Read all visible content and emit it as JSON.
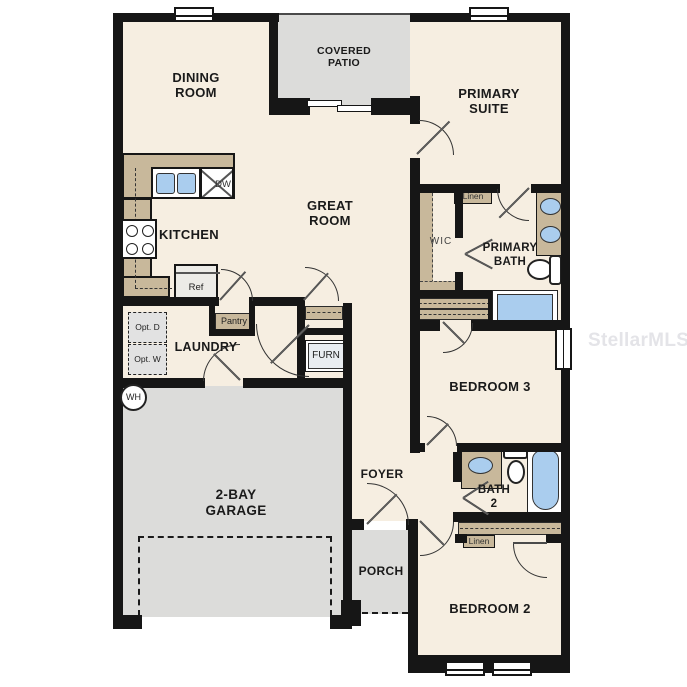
{
  "title": "Single-story floor plan",
  "watermark": "StellarMLS",
  "rooms": {
    "dining_room": "DINING\nROOM",
    "covered_patio": "COVERED\nPATIO",
    "primary_suite": "PRIMARY\nSUITE",
    "kitchen": "KITCHEN",
    "great_room": "GREAT\nROOM",
    "wic": "WIC",
    "primary_bath": "PRIMARY\nBATH",
    "laundry": "LAUNDRY",
    "bedroom_3": "BEDROOM 3",
    "garage": "2-BAY\nGARAGE",
    "foyer": "FOYER",
    "bath_2": "BATH\n2",
    "porch": "PORCH",
    "bedroom_2": "BEDROOM 2"
  },
  "fixtures": {
    "dishwasher": "DW",
    "refrigerator": "Ref",
    "pantry": "Pantry",
    "furnace": "FURN",
    "water_heater": "WH",
    "linen_primary": "Linen",
    "linen_hall": "Linen",
    "optional_dryer": "Opt.\nD",
    "optional_washer": "Opt.\nW"
  },
  "colors": {
    "wall": "#161616",
    "floor": "#f6eee1",
    "outdoor_gray": "#dcdcda",
    "cabinet_tan": "#c8b89b",
    "fixture_blue": "#aacdee",
    "watermark_gray": "#e4e4e8"
  }
}
